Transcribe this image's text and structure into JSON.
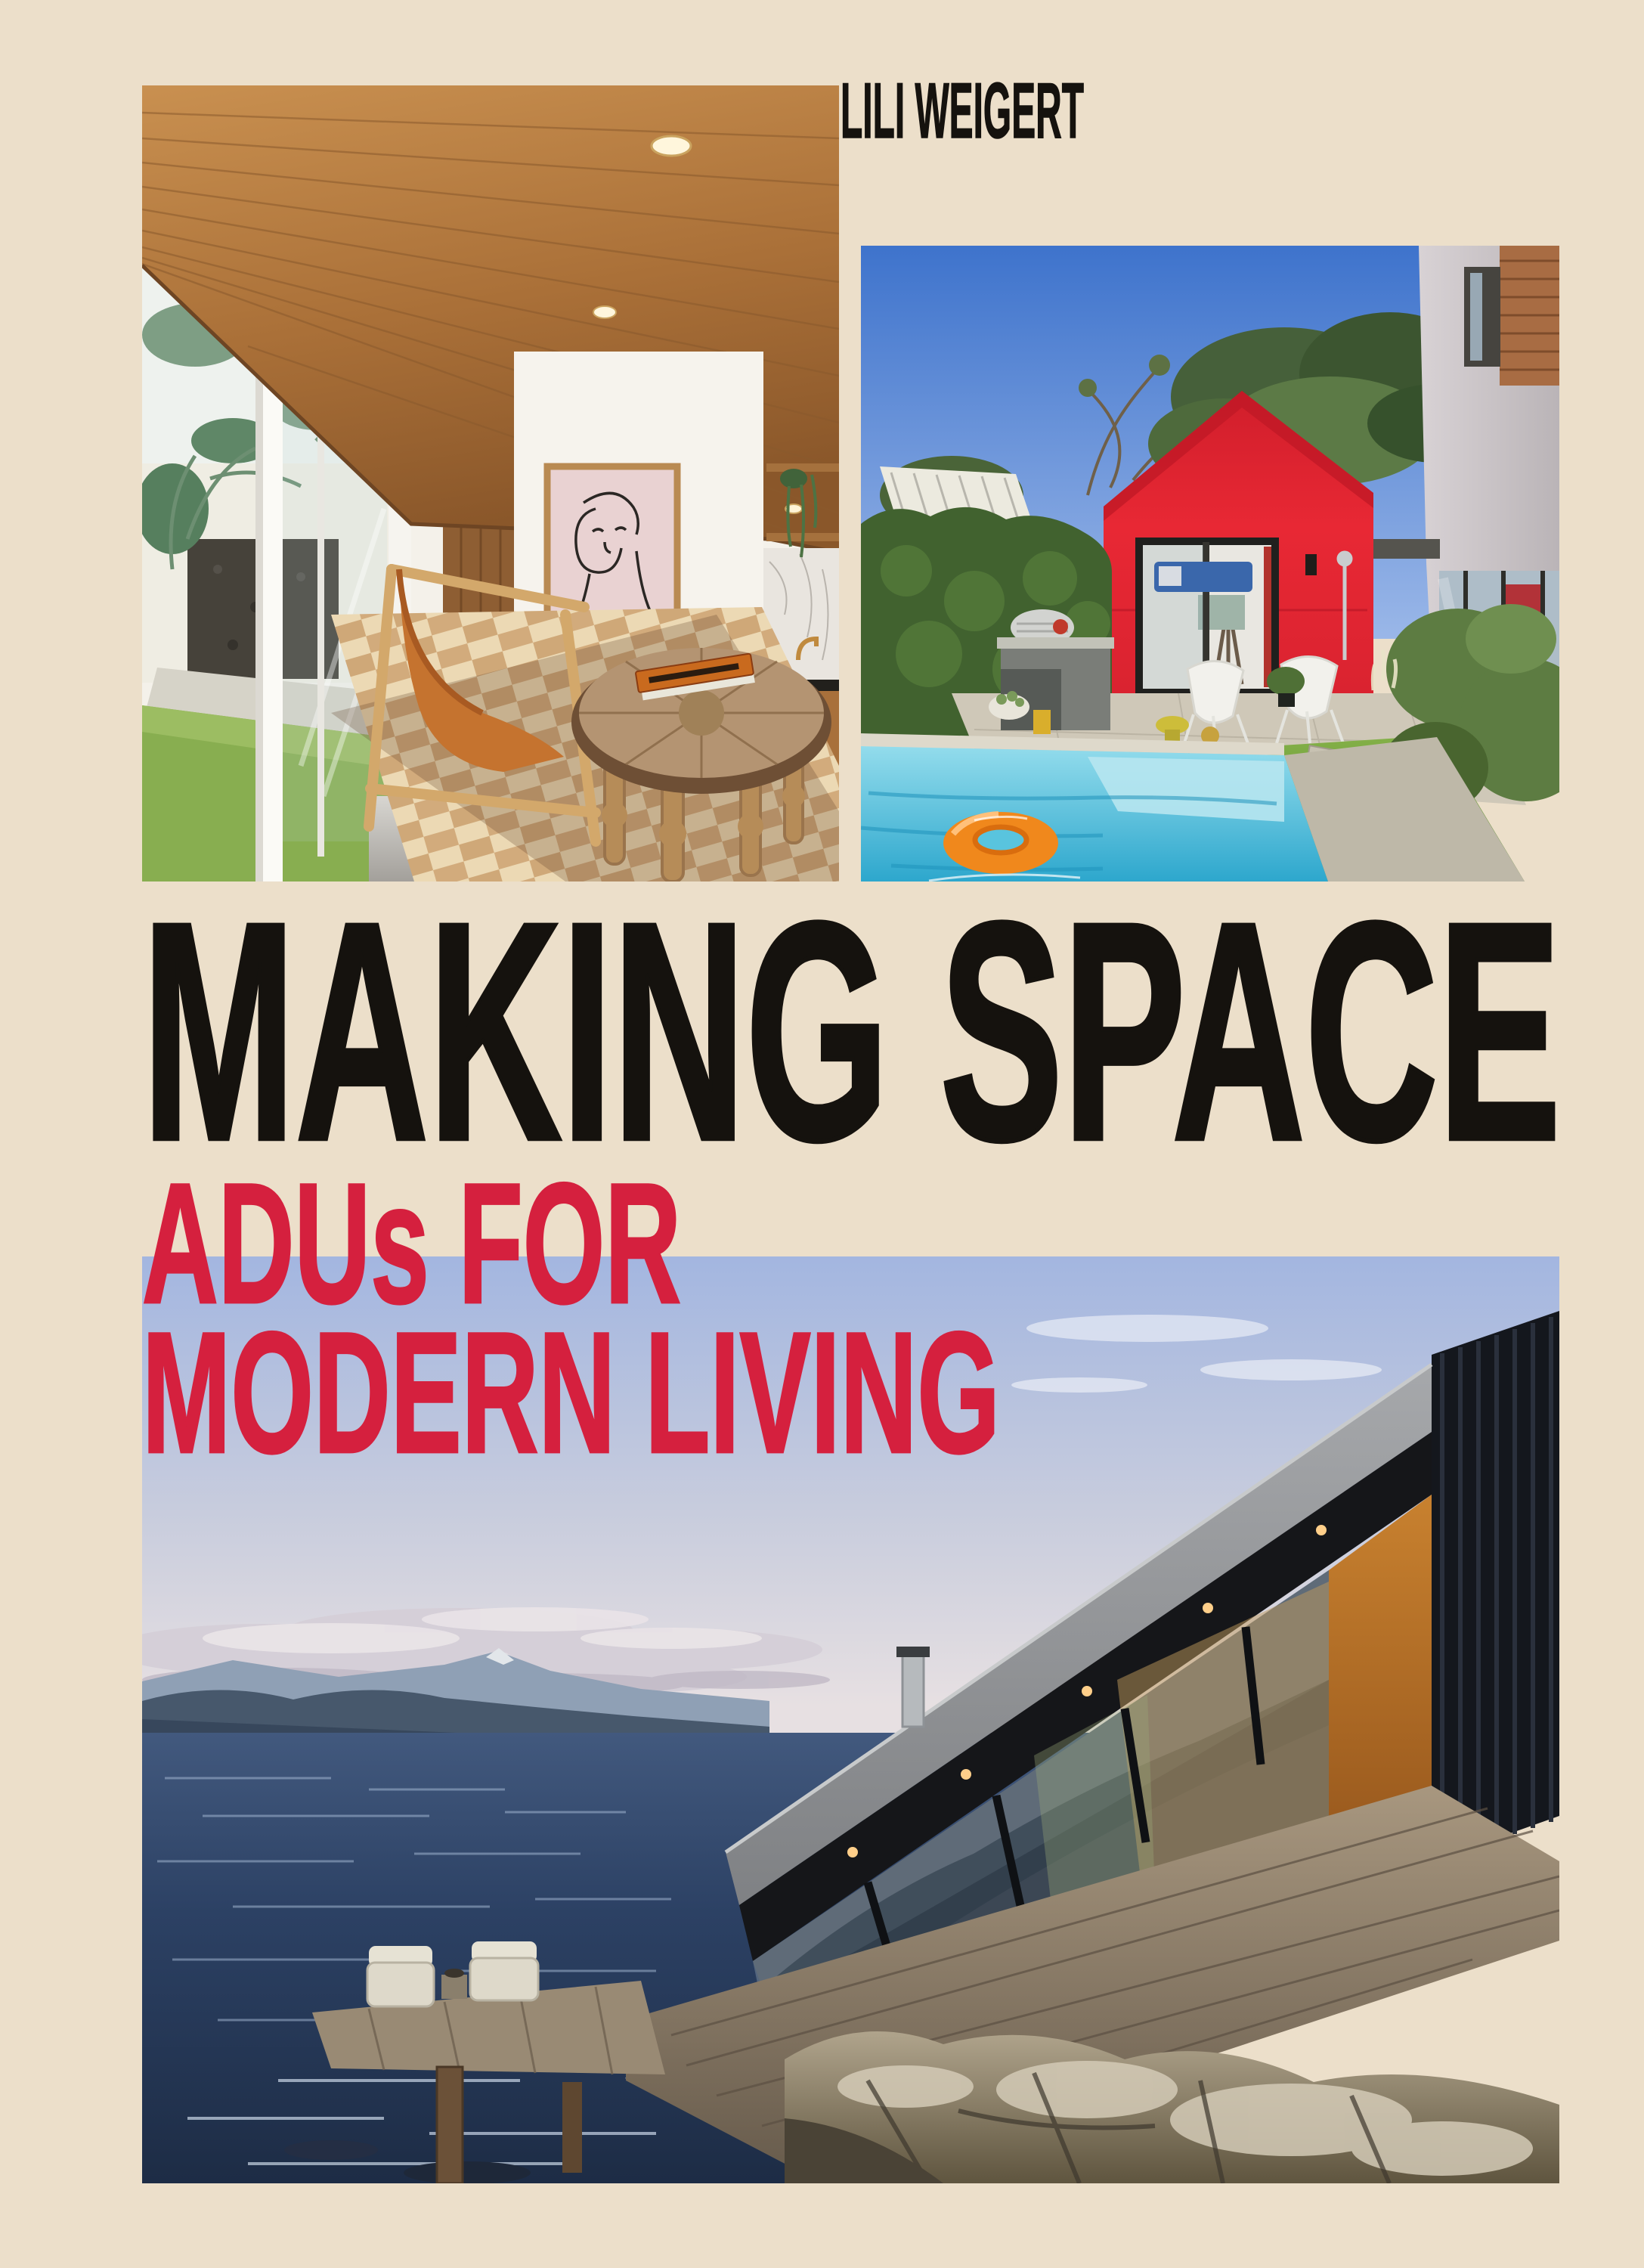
{
  "cover": {
    "author": "LILI WEIGERT",
    "title": "MAKING SPACE",
    "subtitle": {
      "line1": "ADUs FOR",
      "line2": "MODERN LIVING"
    },
    "colors": {
      "background_cream": "#ecdfca",
      "spine_shadow": "#d2c4ab",
      "title_text": "#15120e",
      "subtitle_text": "#d5203e",
      "adu_red_house": "#e02531",
      "pool_water": "#4fc0dc",
      "sky_periwinkle": "#aabde2",
      "ocean_blue": "#2a3f5f"
    },
    "photos": {
      "interior": "Interior living room of an ADU with timber plank ceiling, glass sliding doors to a palm garden, pink framed line-art portrait, leather sling chair, round rustic wood coffee table and woven chevron rug",
      "backyard": "Backyard with turquoise swimming pool, orange inflatable ring, bright red gabled ADU studio, white chairs, outdoor kitchen, grass with paver steps and modern main house",
      "waterfront": "Modern container-style ADU with glass window band and wood deck cantilevered over a rocky shoreline, deep blue water, distant mountains and evening sky"
    }
  }
}
